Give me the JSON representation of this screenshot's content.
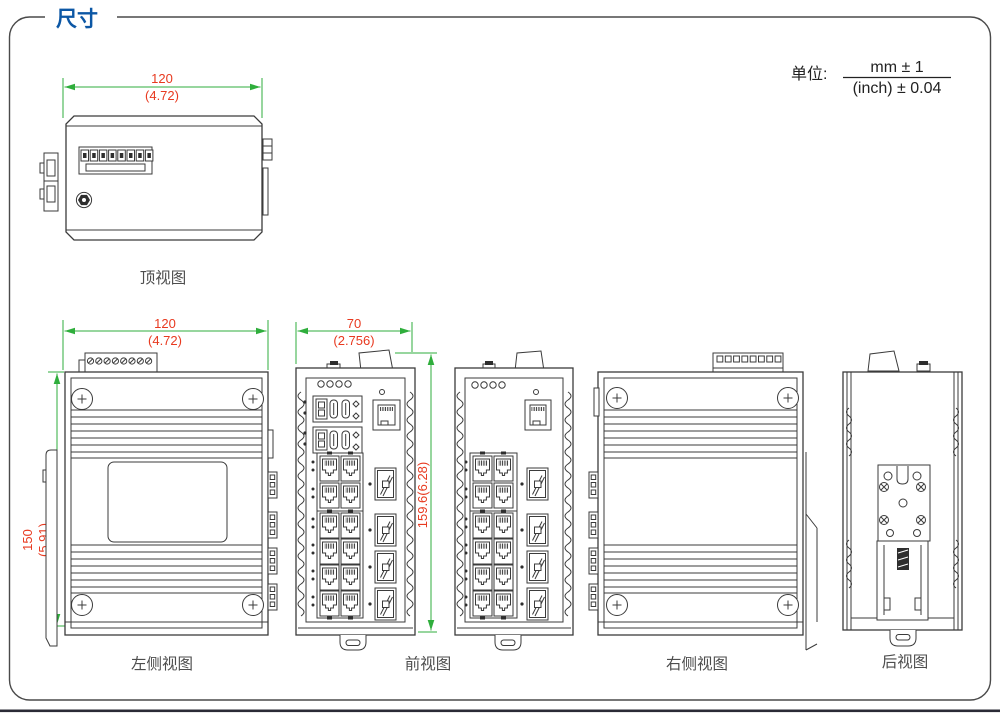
{
  "page": {
    "title": "尺寸",
    "unit": {
      "label": "单位:",
      "numerator": "mm ± 1",
      "denominator": "(inch) ± 0.04"
    }
  },
  "colors": {
    "title_blue": "#0c57a5",
    "dimension_text_red": "#e8391f",
    "dimension_line_green": "#2fae3c",
    "line_art": "#3b3b3b",
    "label_text": "#4d4d4d",
    "footer_bar": "#2b2b36"
  },
  "views": {
    "top": {
      "label": "顶视图",
      "dim_width_mm": "120",
      "dim_width_inch": "(4.72)"
    },
    "left_side": {
      "label": "左侧视图",
      "dim_width_mm": "120",
      "dim_width_inch": "(4.72)",
      "dim_height_mm": "150",
      "dim_height_inch": "(5.91)"
    },
    "front": {
      "label": "前视图",
      "dim_width_mm": "70",
      "dim_width_inch": "(2.756)",
      "dim_height": "159.6(6.28)"
    },
    "right_side": {
      "label": "右侧视图"
    },
    "rear": {
      "label": "后视图"
    }
  }
}
